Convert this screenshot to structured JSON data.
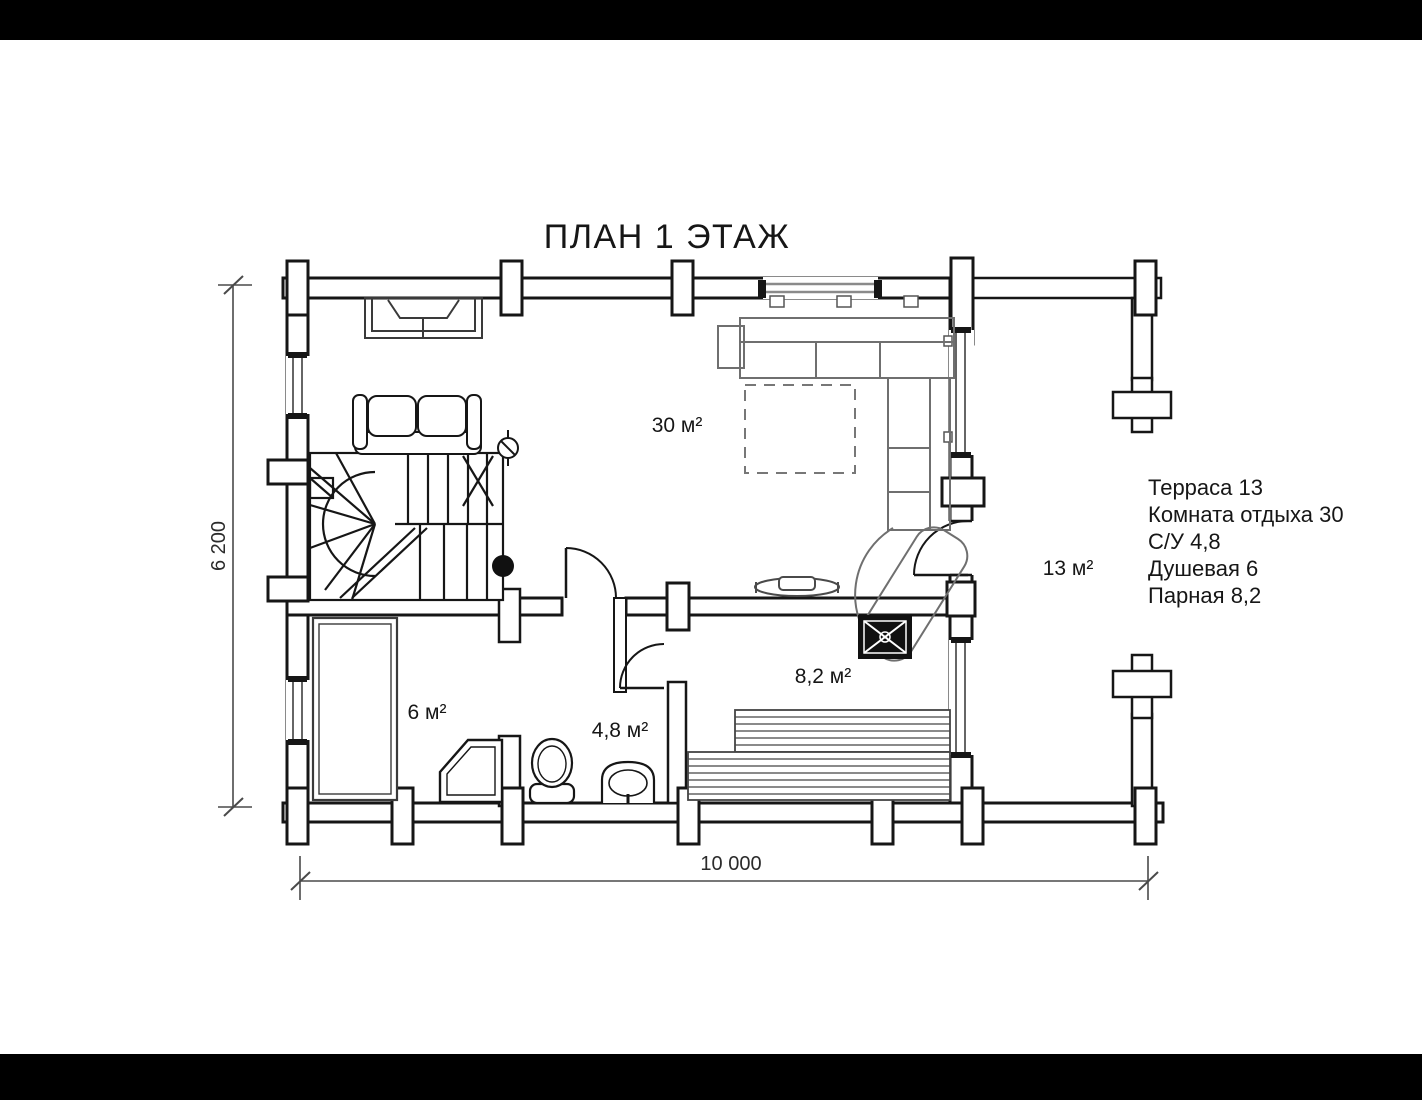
{
  "title": "ПЛАН 1 ЭТАЖ",
  "legend": {
    "items": [
      "Терраса 13",
      "Комната отдыха 30",
      "С/У 4,8",
      "Душевая 6",
      "Парная 8,2"
    ]
  },
  "rooms": {
    "living": "30 м²",
    "terrace": "13 м²",
    "shower": "6 м²",
    "wc": "4,8 м²",
    "sauna": "8,2 м²"
  },
  "dimensions": {
    "width": "10 000",
    "height": "6 200"
  },
  "colors": {
    "letterbox": "#000000",
    "paper": "#ffffff",
    "ink": "#161616",
    "furniture": "#6f6f6f"
  }
}
